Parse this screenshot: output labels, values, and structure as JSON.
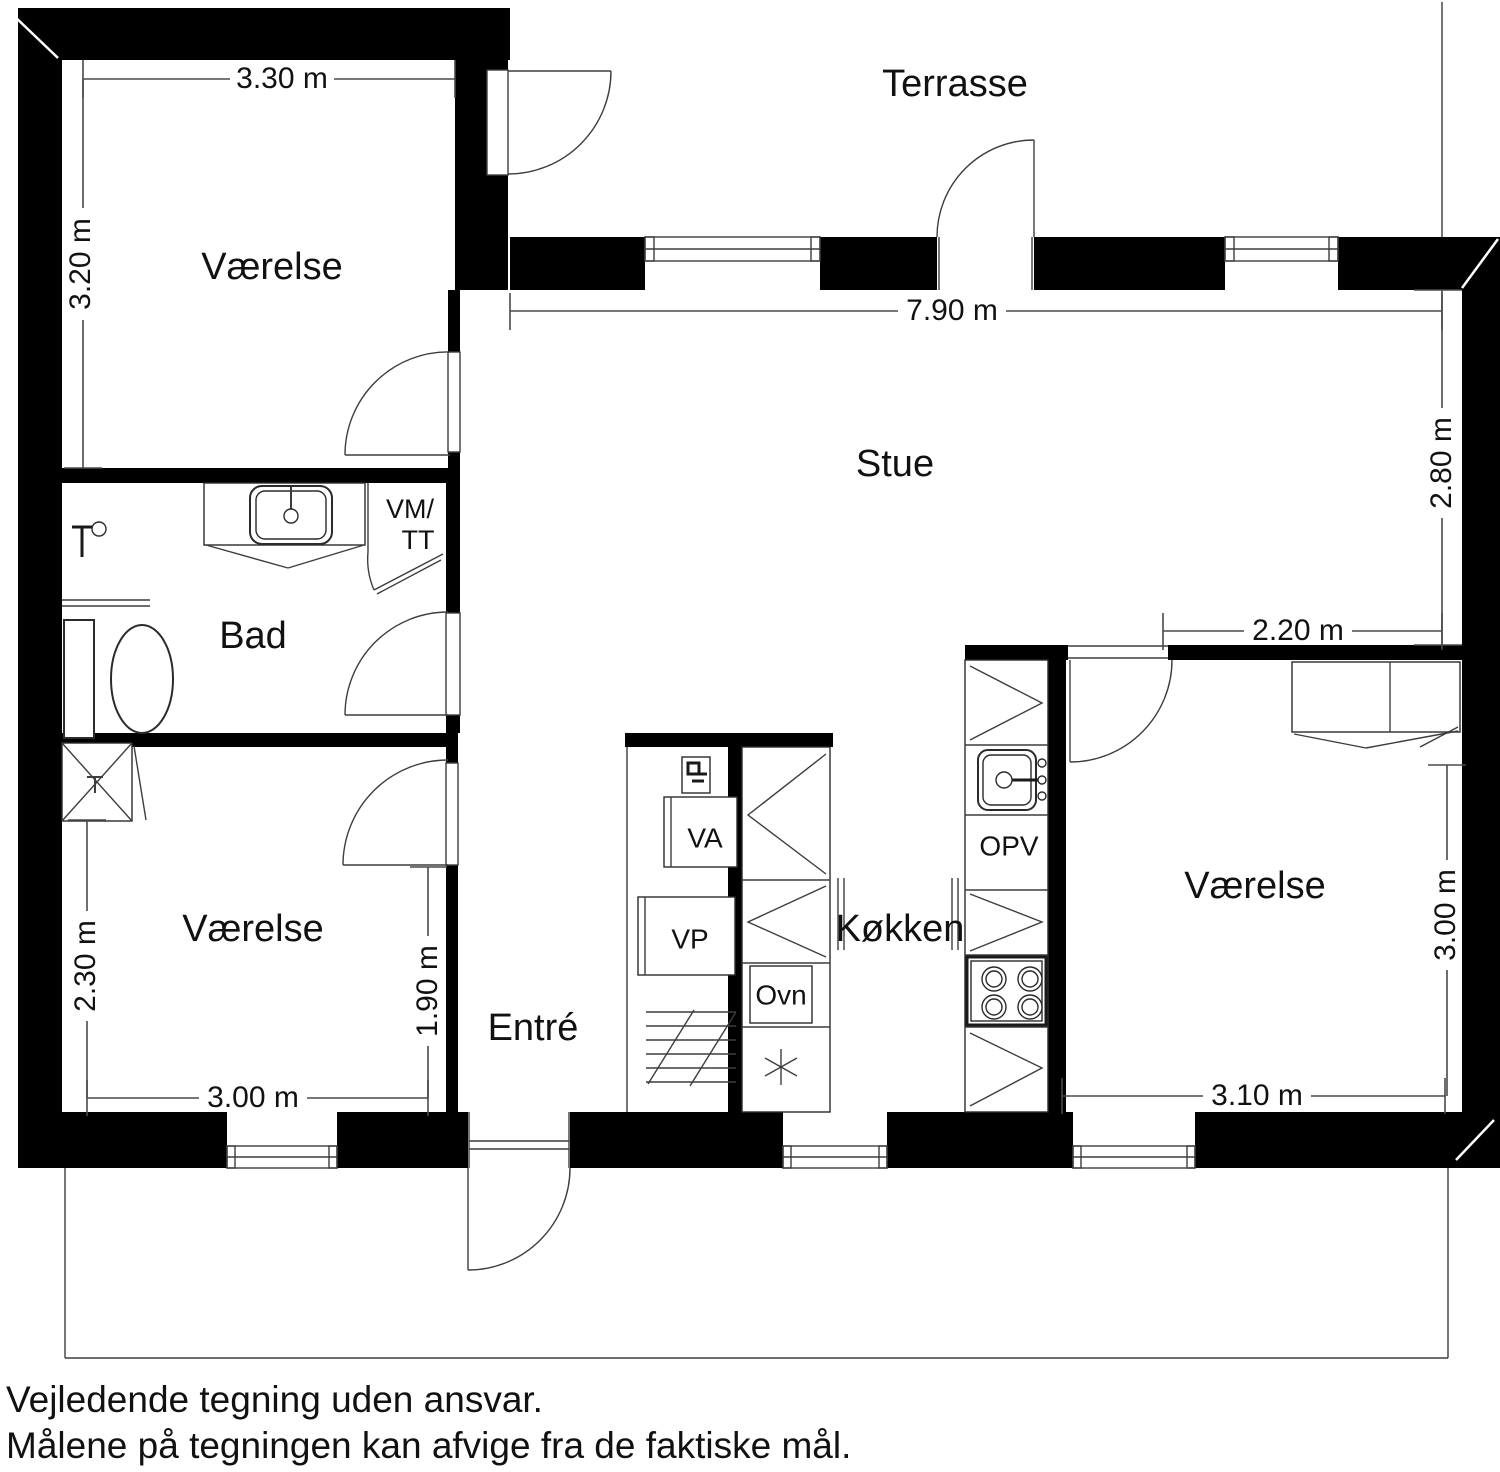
{
  "colors": {
    "wall": "#000000",
    "thin_line": "#3d3d3d",
    "text": "#111111",
    "background": "#ffffff"
  },
  "terrace": {
    "label": "Terrasse"
  },
  "rooms": {
    "bedroom_top_left": {
      "label": "Værelse"
    },
    "living_room": {
      "label": "Stue"
    },
    "bathroom": {
      "label": "Bad"
    },
    "utility_closet": {
      "label_line1": "VM/",
      "label_line2": "TT"
    },
    "bedroom_bottom_left": {
      "label": "Værelse"
    },
    "entrance": {
      "label": "Entré"
    },
    "kitchen": {
      "label": "Køkken"
    },
    "bedroom_right": {
      "label": "Værelse"
    }
  },
  "appliances": {
    "va_unit": "VA",
    "vp_unit": "VP",
    "oven": "Ovn",
    "dishwasher": "OPV"
  },
  "dimensions": {
    "bedroom_tl_width": "3.30 m",
    "bedroom_tl_height": "3.20 m",
    "living_room_width": "7.90 m",
    "living_room_height": "2.80 m",
    "bedroom_r_top_width": "2.20 m",
    "bedroom_r_height": "3.00 m",
    "bedroom_r_width": "3.10 m",
    "bedroom_bl_height_left": "2.30 m",
    "bedroom_bl_height_right": "1.90 m",
    "bedroom_bl_width": "3.00 m"
  },
  "disclaimer": {
    "line1": "Vejledende tegning uden ansvar.",
    "line2": "Målene på tegningen kan afvige fra de faktiske mål."
  }
}
